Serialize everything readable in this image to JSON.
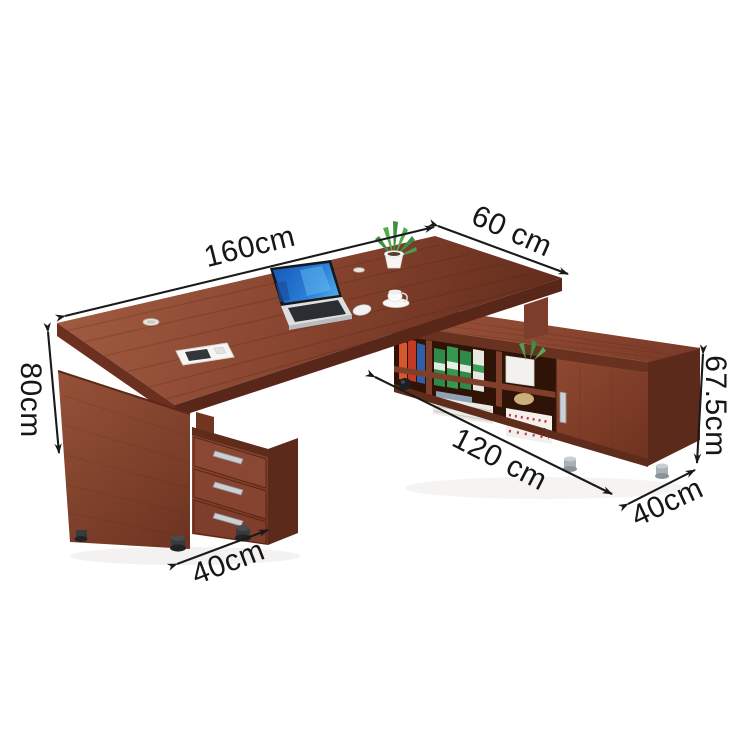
{
  "dims": {
    "desk_length": "160cm",
    "desk_depth": "60 cm",
    "desk_height": "80cm",
    "pedestal_depth": "40cm",
    "return_length": "120 cm",
    "return_height": "67.5cm",
    "return_depth": "40cm"
  },
  "colors": {
    "background": "#ffffff",
    "annotation_black": "#161616",
    "wood_light": "#a05a40",
    "wood_mid": "#84432e",
    "wood_dark": "#5c2a1b",
    "wood_edge": "#6b3020",
    "shelf_interior": "#2e1306",
    "laptop_screen_blue": "#1f6fd0",
    "laptop_body_silver": "#dcdee0",
    "handle_silver": "#ccd0d4",
    "binder_orange": "#d4572e",
    "binder_red": "#c23a24",
    "binder_blue": "#2e5fa8",
    "binder_green": "#2e8a48",
    "books_white": "#f2f0ed",
    "plant_green": "#3e8f45",
    "pot_white": "#f6f6f4"
  }
}
